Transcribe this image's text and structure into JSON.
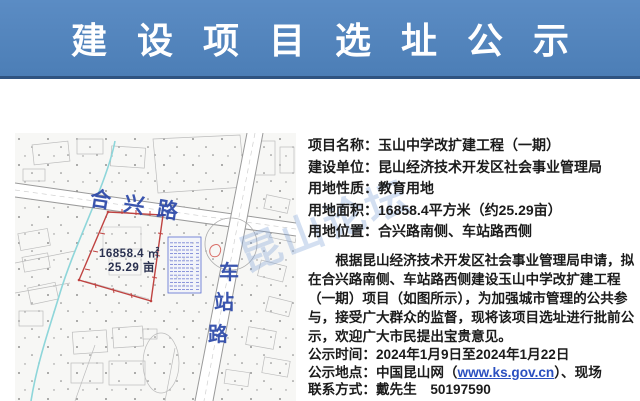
{
  "header": {
    "title": "建设项目选址公示",
    "bg_color": "#4f81bd",
    "text_color": "#ffffff"
  },
  "map": {
    "road_hexing": "合兴路",
    "road_chezhan_chars": [
      "车",
      "站",
      "路"
    ],
    "parcel": {
      "area_m2": "16858.4 ㎡",
      "area_mu": "25.29 亩",
      "outline_color": "#bf4341"
    },
    "label_color": "#2a47a8"
  },
  "watermark": {
    "text": "昆山论坛"
  },
  "details": {
    "rows": [
      {
        "label": "项目名称：",
        "value": "玉山中学改扩建工程（一期）"
      },
      {
        "label": "建设单位：",
        "value": "昆山经济技术开发区社会事业管理局"
      },
      {
        "label": "用地性质：",
        "value": "教育用地"
      },
      {
        "label": "用地面积：",
        "value": "16858.4平方米（约25.29亩）"
      },
      {
        "label": "用地位置：",
        "value": "合兴路南侧、车站路西侧"
      }
    ],
    "paragraph_lines": [
      "根据昆山经济技术开发区社会事业管理局申请，拟",
      "在合兴路南侧、车站路西侧建设玉山中学改扩建工程",
      "（一期）项目（如图所示），为加强城市管理的公共参",
      "与，接受广大群众的监督，现将该项目选址进行批前公",
      "示，欢迎广大市民提出宝贵意见。"
    ],
    "footer": {
      "time_label": "公示时间：",
      "time_value": "2024年1月9日至2024年1月22日",
      "place_label": "公示地点：",
      "place_prefix": "中国昆山网（",
      "place_url": "www.ks.gov.cn",
      "place_suffix": "）、现场",
      "contact_label": "联系方式：",
      "contact_value": "戴先生　50197590"
    }
  }
}
